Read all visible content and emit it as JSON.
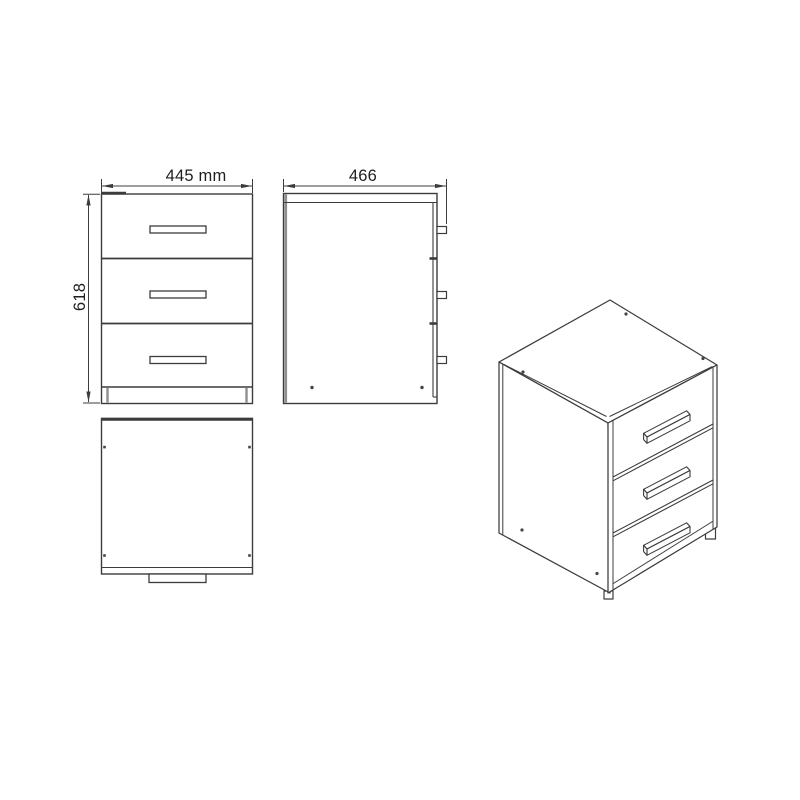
{
  "page": {
    "background": "#ffffff",
    "content_type": "furniture technical drawing"
  },
  "drawing": {
    "subject": "three-drawer cabinet",
    "drawer_count": 3,
    "views": {
      "front": {
        "name": "front view",
        "width_label": "445 mm",
        "height_label": "618"
      },
      "side": {
        "name": "side view",
        "depth_label": "466"
      },
      "top": {
        "name": "top view"
      },
      "perspective": {
        "name": "perspective view"
      }
    }
  },
  "colors": {
    "line": "#3c3c3c",
    "soft_line": "#8f8f8f",
    "dot": "#454545",
    "text": "#1e1e1e"
  }
}
